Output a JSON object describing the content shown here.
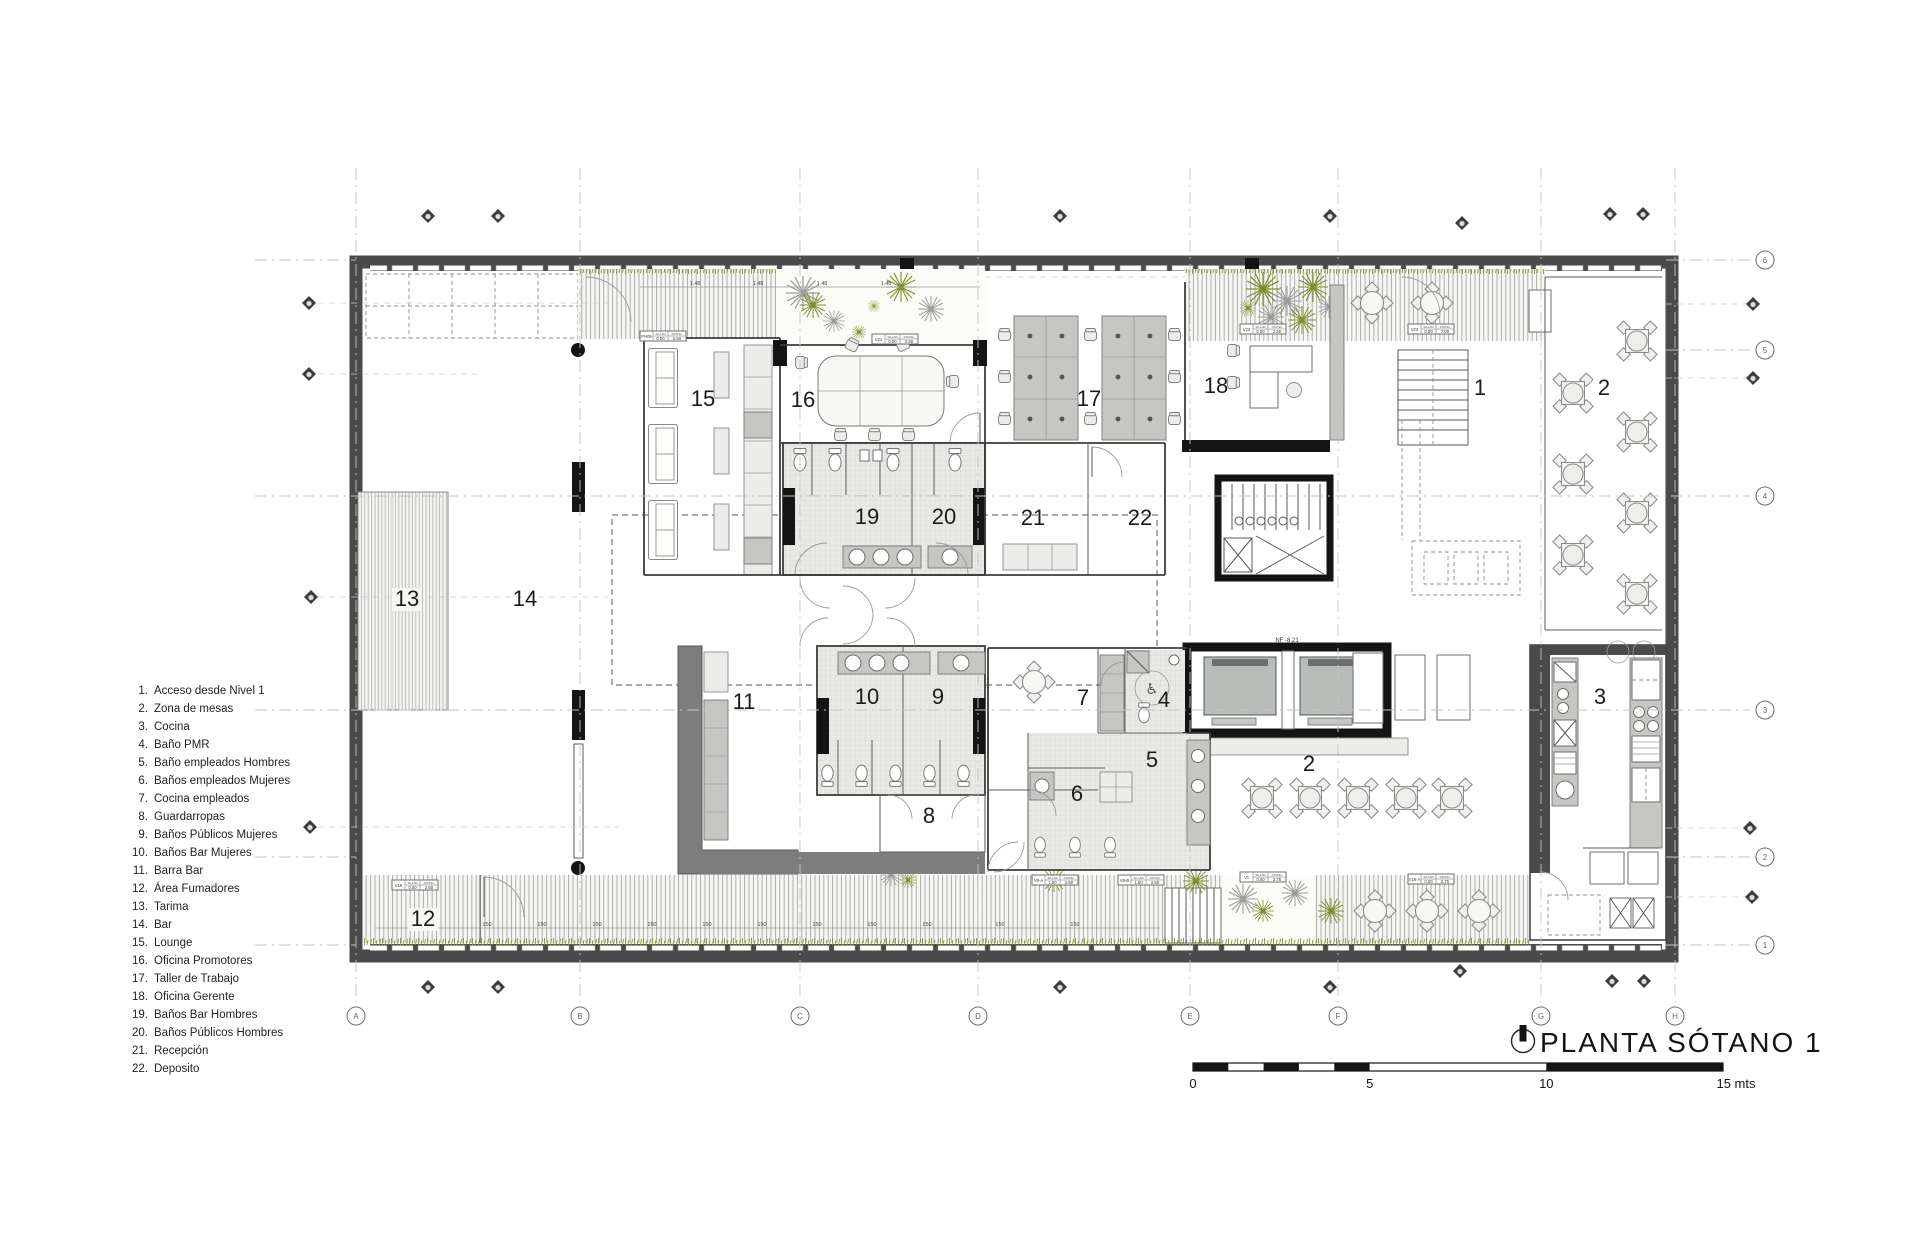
{
  "drawing_title": {
    "text": "PLANTA SÓTANO 1"
  },
  "scale_bar": {
    "labels": [
      "0",
      "5",
      "10",
      "15 mts"
    ]
  },
  "legend": {
    "items": [
      {
        "num": "1.",
        "text": "Acceso desde Nivel 1"
      },
      {
        "num": "2.",
        "text": "Zona de mesas"
      },
      {
        "num": "3.",
        "text": "Cocina"
      },
      {
        "num": "4.",
        "text": "Baño PMR"
      },
      {
        "num": "5.",
        "text": "Baño empleados Hombres"
      },
      {
        "num": "6.",
        "text": "Baños empleados Mujeres"
      },
      {
        "num": "7.",
        "text": "Cocina empleados"
      },
      {
        "num": "8.",
        "text": "Guardarropas"
      },
      {
        "num": "9.",
        "text": "Baños Públicos Mujeres"
      },
      {
        "num": "10.",
        "text": "Baños Bar Mujeres"
      },
      {
        "num": "11.",
        "text": "Barra Bar"
      },
      {
        "num": "12.",
        "text": "Área Fumadores"
      },
      {
        "num": "13.",
        "text": "Tarima"
      },
      {
        "num": "14.",
        "text": "Bar"
      },
      {
        "num": "15.",
        "text": "Lounge"
      },
      {
        "num": "16.",
        "text": "Oficina Promotores"
      },
      {
        "num": "17.",
        "text": "Taller de Trabajo"
      },
      {
        "num": "18.",
        "text": "Oficina Gerente"
      },
      {
        "num": "19.",
        "text": "Baños Bar Hombres"
      },
      {
        "num": "20.",
        "text": "Baños Públicos Hombres"
      },
      {
        "num": "21.",
        "text": "Recepción"
      },
      {
        "num": "22.",
        "text": "Deposito"
      }
    ]
  },
  "grid": {
    "columns": [
      "A",
      "B",
      "C",
      "D",
      "E",
      "F",
      "G",
      "H"
    ],
    "rows": [
      "6",
      "5",
      "4",
      "3",
      "2",
      "1"
    ]
  },
  "rooms": {
    "n1": "1",
    "n2": "2",
    "n3": "3",
    "n4": "4",
    "n5": "5",
    "n6": "6",
    "n7": "7",
    "n8": "8",
    "n9": "9",
    "n10": "10",
    "n11": "11",
    "n12": "12",
    "n13": "13",
    "n14": "14",
    "n15": "15",
    "n16": "16",
    "n17": "17",
    "n18": "18",
    "n19": "19",
    "n20": "20",
    "n21": "21",
    "n22": "22"
  },
  "window_tag_headers": [
    "SILLAR",
    "DINTEL"
  ],
  "window_tags": [
    {
      "id": "PH09",
      "sillar": "0.00",
      "dintel": "2.60"
    },
    {
      "id": "V21",
      "sillar": "0.00",
      "dintel": "2.60"
    },
    {
      "id": "V22",
      "sillar": "0.00",
      "dintel": "2.60"
    },
    {
      "id": "V23",
      "sillar": "0.00",
      "dintel": "7.00"
    },
    {
      "id": "V19",
      "sillar": "0.00",
      "dintel": "2.60"
    },
    {
      "id": "V8-A",
      "sillar": "1.50",
      "dintel": "2.60"
    },
    {
      "id": "V8-B",
      "sillar": "1.50",
      "dintel": "2.60"
    },
    {
      "id": "V1",
      "sillar": "0.00",
      "dintel": "3.75"
    },
    {
      "id": "V16-A",
      "sillar": "0.00",
      "dintel": "2.75"
    }
  ],
  "dims": {
    "bottom": "150",
    "top": "1.48"
  },
  "annotations": {
    "elevator_level": "NF -8.21"
  },
  "icons": {
    "wheelchair": "♿",
    "north_symbol": "north-indicator"
  },
  "colors": {
    "wall_dark": "#4a4a4a",
    "wall_black": "#141414",
    "wall_medium": "#7d7d7d",
    "tile_fill": "#e9e9e5",
    "furniture_gray": "#c6c6c3",
    "plant_green": "#7e8f28",
    "plant_gray": "#9a9a9a",
    "grass_green": "#7e9630"
  }
}
